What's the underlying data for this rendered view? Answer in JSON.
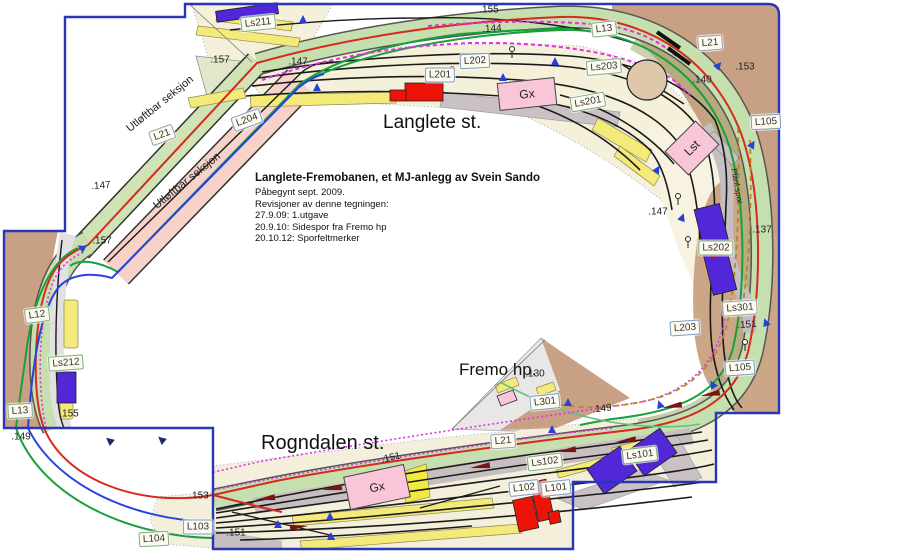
{
  "diagram": {
    "title_block": {
      "title": "Langlete-Fremobanen, et MJ-anlegg av Svein Sando",
      "lines": [
        "Påbegynt sept. 2009.",
        "Revisjoner av denne tegningen:",
        "27.9.09: 1.utgave",
        "20.9.10: Sidespor fra Fremo hp",
        "20.10.12: Sporfeltmerker"
      ]
    },
    "stations": [
      {
        "name": "Langlete st.",
        "x": 383,
        "y": 112,
        "size": 19
      },
      {
        "name": "Rogndalen st.",
        "x": 261,
        "y": 432,
        "size": 20
      },
      {
        "name": "Fremo hp.",
        "x": 459,
        "y": 360,
        "size": 17
      }
    ],
    "section_labels": [
      {
        "text": "Ls211",
        "x": 258,
        "y": 23,
        "border": "green",
        "rot": -6
      },
      {
        "text": "L13",
        "x": 604,
        "y": 29,
        "border": "green",
        "rot": -6
      },
      {
        "text": "L21",
        "x": 710,
        "y": 43,
        "border": "gray",
        "rot": -4
      },
      {
        "text": "L202",
        "x": 475,
        "y": 61,
        "border": "blue",
        "rot": -3
      },
      {
        "text": "Ls203",
        "x": 604,
        "y": 67,
        "border": "green",
        "rot": -5
      },
      {
        "text": "L201",
        "x": 440,
        "y": 75,
        "border": "blue",
        "rot": 0
      },
      {
        "text": "Ls201",
        "x": 588,
        "y": 102,
        "border": "green",
        "rot": -10
      },
      {
        "text": "L105",
        "x": 766,
        "y": 122,
        "border": "blue",
        "rot": -3
      },
      {
        "text": "L204",
        "x": 247,
        "y": 120,
        "border": "blue",
        "rot": -20
      },
      {
        "text": "L21",
        "x": 162,
        "y": 135,
        "border": "gray",
        "rot": -20
      },
      {
        "text": "Ls202",
        "x": 716,
        "y": 248,
        "border": "green",
        "rot": 0
      },
      {
        "text": "L12",
        "x": 37,
        "y": 315,
        "border": "green",
        "rot": -8
      },
      {
        "text": "Ls212",
        "x": 66,
        "y": 363,
        "border": "green",
        "rot": -4
      },
      {
        "text": "L13",
        "x": 20,
        "y": 411,
        "border": "green",
        "rot": -3
      },
      {
        "text": "L203",
        "x": 685,
        "y": 328,
        "border": "blue",
        "rot": -4
      },
      {
        "text": "Ls301",
        "x": 740,
        "y": 308,
        "border": "gray",
        "rot": -4
      },
      {
        "text": "L105",
        "x": 740,
        "y": 368,
        "border": "blue",
        "rot": -4
      },
      {
        "text": "L301",
        "x": 545,
        "y": 402,
        "border": "blue",
        "rot": -6
      },
      {
        "text": "L21",
        "x": 503,
        "y": 441,
        "border": "gray",
        "rot": -4
      },
      {
        "text": "Ls102",
        "x": 545,
        "y": 462,
        "border": "green",
        "rot": -7
      },
      {
        "text": "Ls101",
        "x": 640,
        "y": 455,
        "border": "green",
        "rot": -7
      },
      {
        "text": "L102",
        "x": 524,
        "y": 488,
        "border": "blue",
        "rot": -6
      },
      {
        "text": "L101",
        "x": 556,
        "y": 488,
        "border": "blue",
        "rot": -6
      },
      {
        "text": "L103",
        "x": 198,
        "y": 527,
        "border": "blue",
        "rot": 0
      },
      {
        "text": "L104",
        "x": 154,
        "y": 539,
        "border": "green",
        "rot": -3
      }
    ],
    "building_labels": [
      {
        "text": "Gx",
        "x": 527,
        "y": 94,
        "w": 56,
        "h": 26,
        "rot": -6
      },
      {
        "text": "Gx",
        "x": 377,
        "y": 487,
        "w": 60,
        "h": 32,
        "rot": -12
      },
      {
        "text": "Lst",
        "x": 692,
        "y": 148,
        "w": 42,
        "h": 32,
        "rot": -45
      }
    ],
    "measurements": [
      {
        "text": ".155",
        "x": 489,
        "y": 10,
        "rot": 0
      },
      {
        "text": ".144",
        "x": 492,
        "y": 29,
        "rot": -3
      },
      {
        "text": ".157",
        "x": 220,
        "y": 60,
        "rot": 0
      },
      {
        "text": ".147",
        "x": 298,
        "y": 62,
        "rot": 0
      },
      {
        "text": ".153",
        "x": 745,
        "y": 67,
        "rot": 0
      },
      {
        "text": ".140",
        "x": 702,
        "y": 80,
        "rot": 0
      },
      {
        "text": ".147",
        "x": 101,
        "y": 186,
        "rot": -5
      },
      {
        "text": ".157",
        "x": 102,
        "y": 241,
        "rot": 0
      },
      {
        "text": ".147",
        "x": 658,
        "y": 212,
        "rot": 0
      },
      {
        "text": ".137",
        "x": 762,
        "y": 230,
        "rot": 0
      },
      {
        "text": ".151",
        "x": 747,
        "y": 325,
        "rot": -4
      },
      {
        "text": ".155",
        "x": 69,
        "y": 414,
        "rot": 0
      },
      {
        "text": ".149",
        "x": 21,
        "y": 437,
        "rot": 0
      },
      {
        "text": ".130",
        "x": 535,
        "y": 374,
        "rot": 0
      },
      {
        "text": ".149",
        "x": 602,
        "y": 409,
        "rot": -6
      },
      {
        "text": ".151",
        "x": 391,
        "y": 458,
        "rot": -13
      },
      {
        "text": ".153",
        "x": 199,
        "y": 496,
        "rot": 0
      },
      {
        "text": ".151",
        "x": 236,
        "y": 533,
        "rot": 0
      }
    ],
    "captions": [
      {
        "text": "Utløftbar seksjon",
        "x": 160,
        "y": 104,
        "rot": -39
      },
      {
        "text": "Utløftbar seksjon",
        "x": 187,
        "y": 181,
        "rot": -39
      },
      {
        "text": "Planl.spor",
        "x": 737,
        "y": 186,
        "rot": 80,
        "size": 8
      }
    ],
    "colors": {
      "board_outline": "#2a35b8",
      "mainline_red": "#d62920",
      "line_green": "#19a03c",
      "line_blue": "#2742e0",
      "dashed_magenta": "#e52ee5",
      "dashed_tan": "#b8862b",
      "band_green": "#c6dfae",
      "band_pink": "#f6d2c8",
      "terrain_brown": "#c8a184",
      "yard_cream": "#f4efdb",
      "platform_yellow": "#f3ea7a",
      "platform_gray": "#c9c1c4",
      "building_red": "#ee1309",
      "building_blue": "#5227d8",
      "building_pink": "#f9c6d9"
    }
  }
}
